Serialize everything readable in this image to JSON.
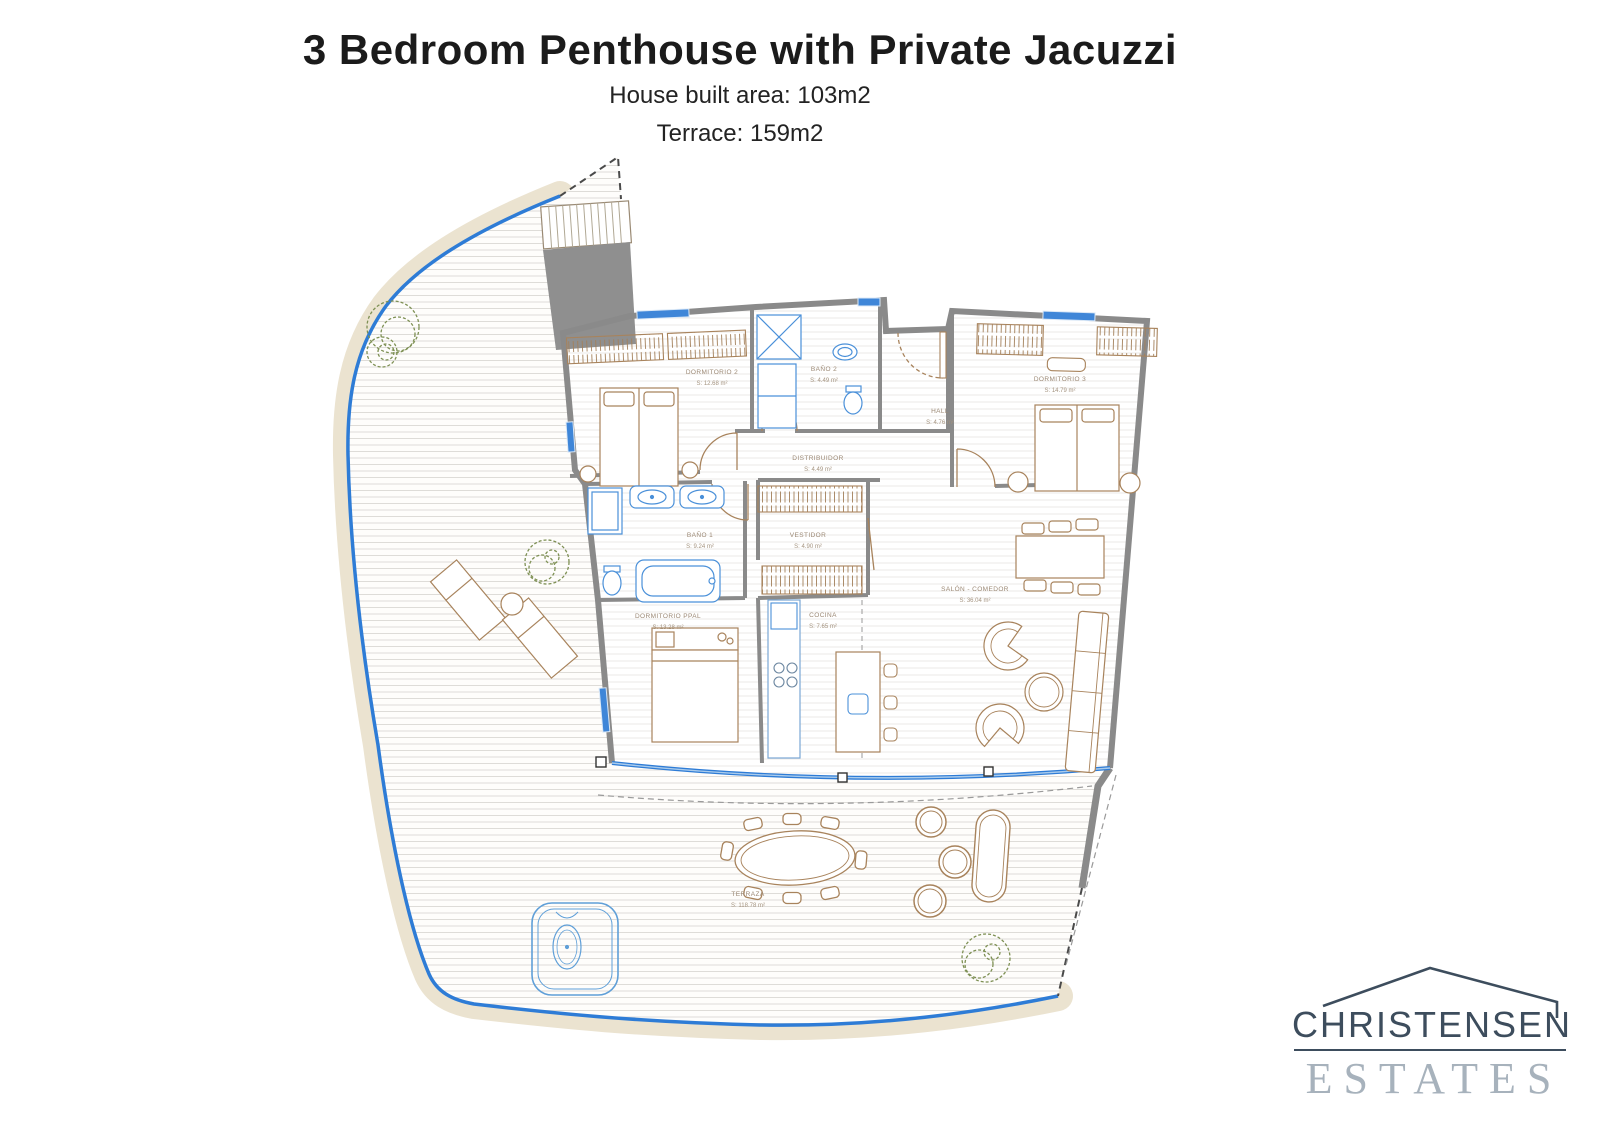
{
  "header": {
    "title": "3 Bedroom Penthouse with Private Jacuzzi",
    "subtitle_line1": "House built area: 103m2",
    "subtitle_line2": "Terrace: 159m2"
  },
  "floor_plan": {
    "rooms": [
      {
        "name": "DORMITORIO 2",
        "area": "S: 12.68 m²"
      },
      {
        "name": "BAÑO 2",
        "area": "S: 4.49 m²"
      },
      {
        "name": "HALL",
        "area": "S: 4.76 m²"
      },
      {
        "name": "DORMITORIO 3",
        "area": "S: 14.79 m²"
      },
      {
        "name": "DISTRIBUIDOR",
        "area": "S: 4.49 m²"
      },
      {
        "name": "BAÑO 1",
        "area": "S: 9.24 m²"
      },
      {
        "name": "VESTIDOR",
        "area": "S: 4.90 m²"
      },
      {
        "name": "SALÓN - COMEDOR",
        "area": "S: 36.04 m²"
      },
      {
        "name": "DORMITORIO PPAL",
        "area": "S: 13.28 m²"
      },
      {
        "name": "COCINA",
        "area": "S: 7.65 m²"
      },
      {
        "name": "TERRAZA",
        "area": "S: 118.78 m²"
      }
    ],
    "colors": {
      "terrace_band": "#ebe3d0",
      "water_line": "#2e7cd6",
      "walls": "#8a8a8a",
      "fixtures_blue": "#4a90d9",
      "furniture_brown": "#a8835c",
      "plant_green": "#7e9054",
      "label_text": "#9b8874"
    }
  },
  "logo": {
    "line1": "CHRISTENSEN",
    "line2": "ESTATES"
  }
}
